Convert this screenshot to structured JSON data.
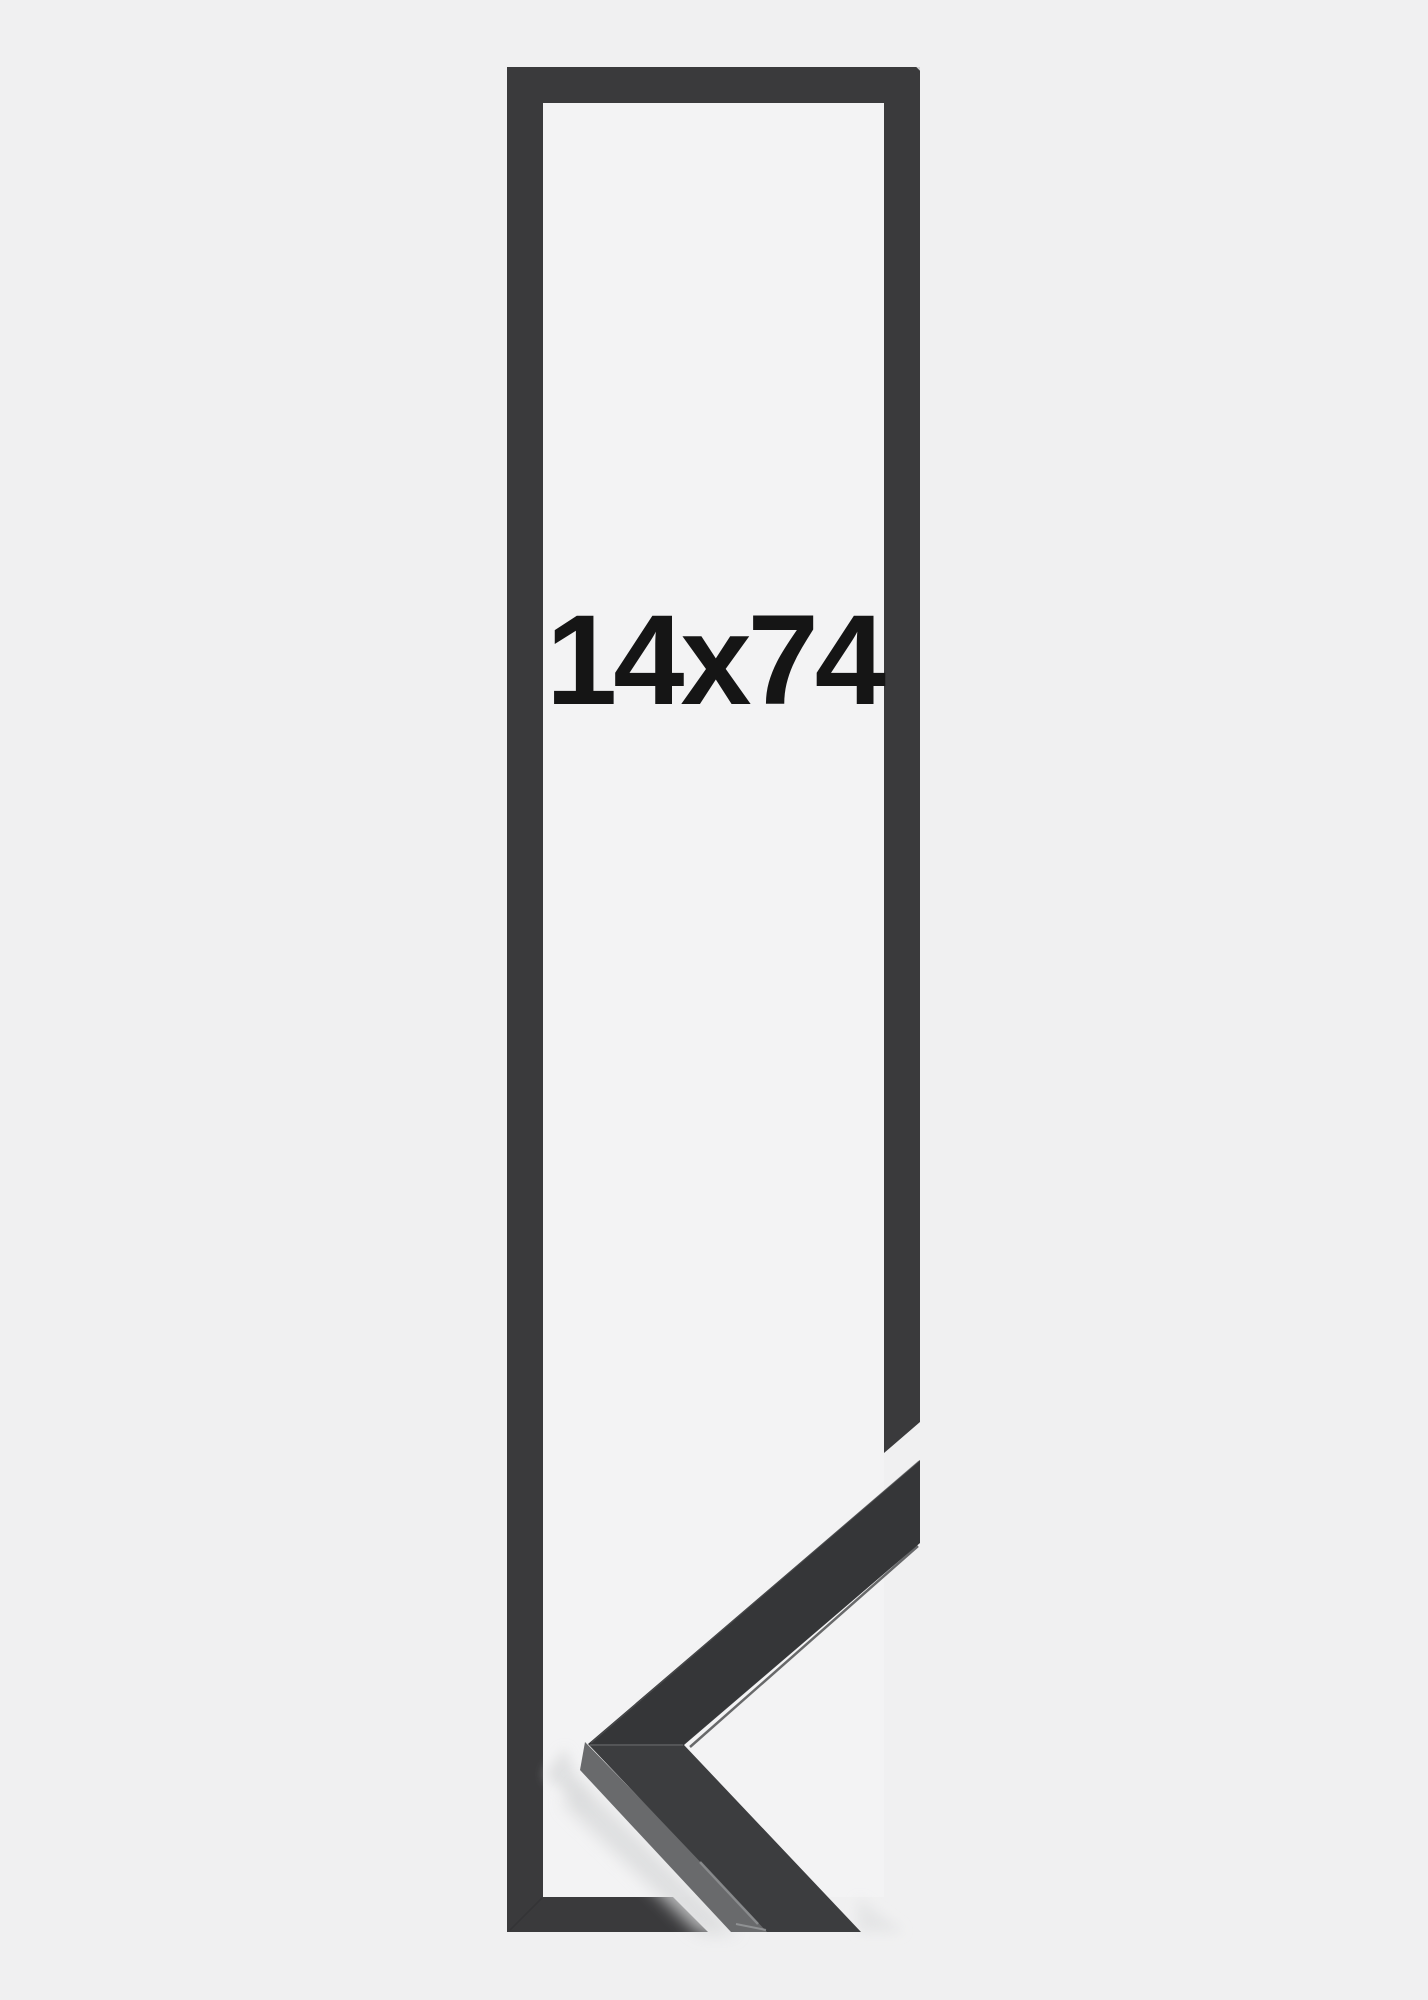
{
  "image": {
    "size_label": "14x74",
    "description_label": "frame-size-product-graphic"
  },
  "colors": {
    "background": "#f0f0f1",
    "frame_opening": "#f3f3f4",
    "frame_outline": "#3a3a3c",
    "sample_face": "#3c3d3f",
    "sample_side_face": "#696a6c",
    "sample_edge_highlight": "#8f9193",
    "cast_shadow": "#d9dadb",
    "label_text": "#151515"
  }
}
